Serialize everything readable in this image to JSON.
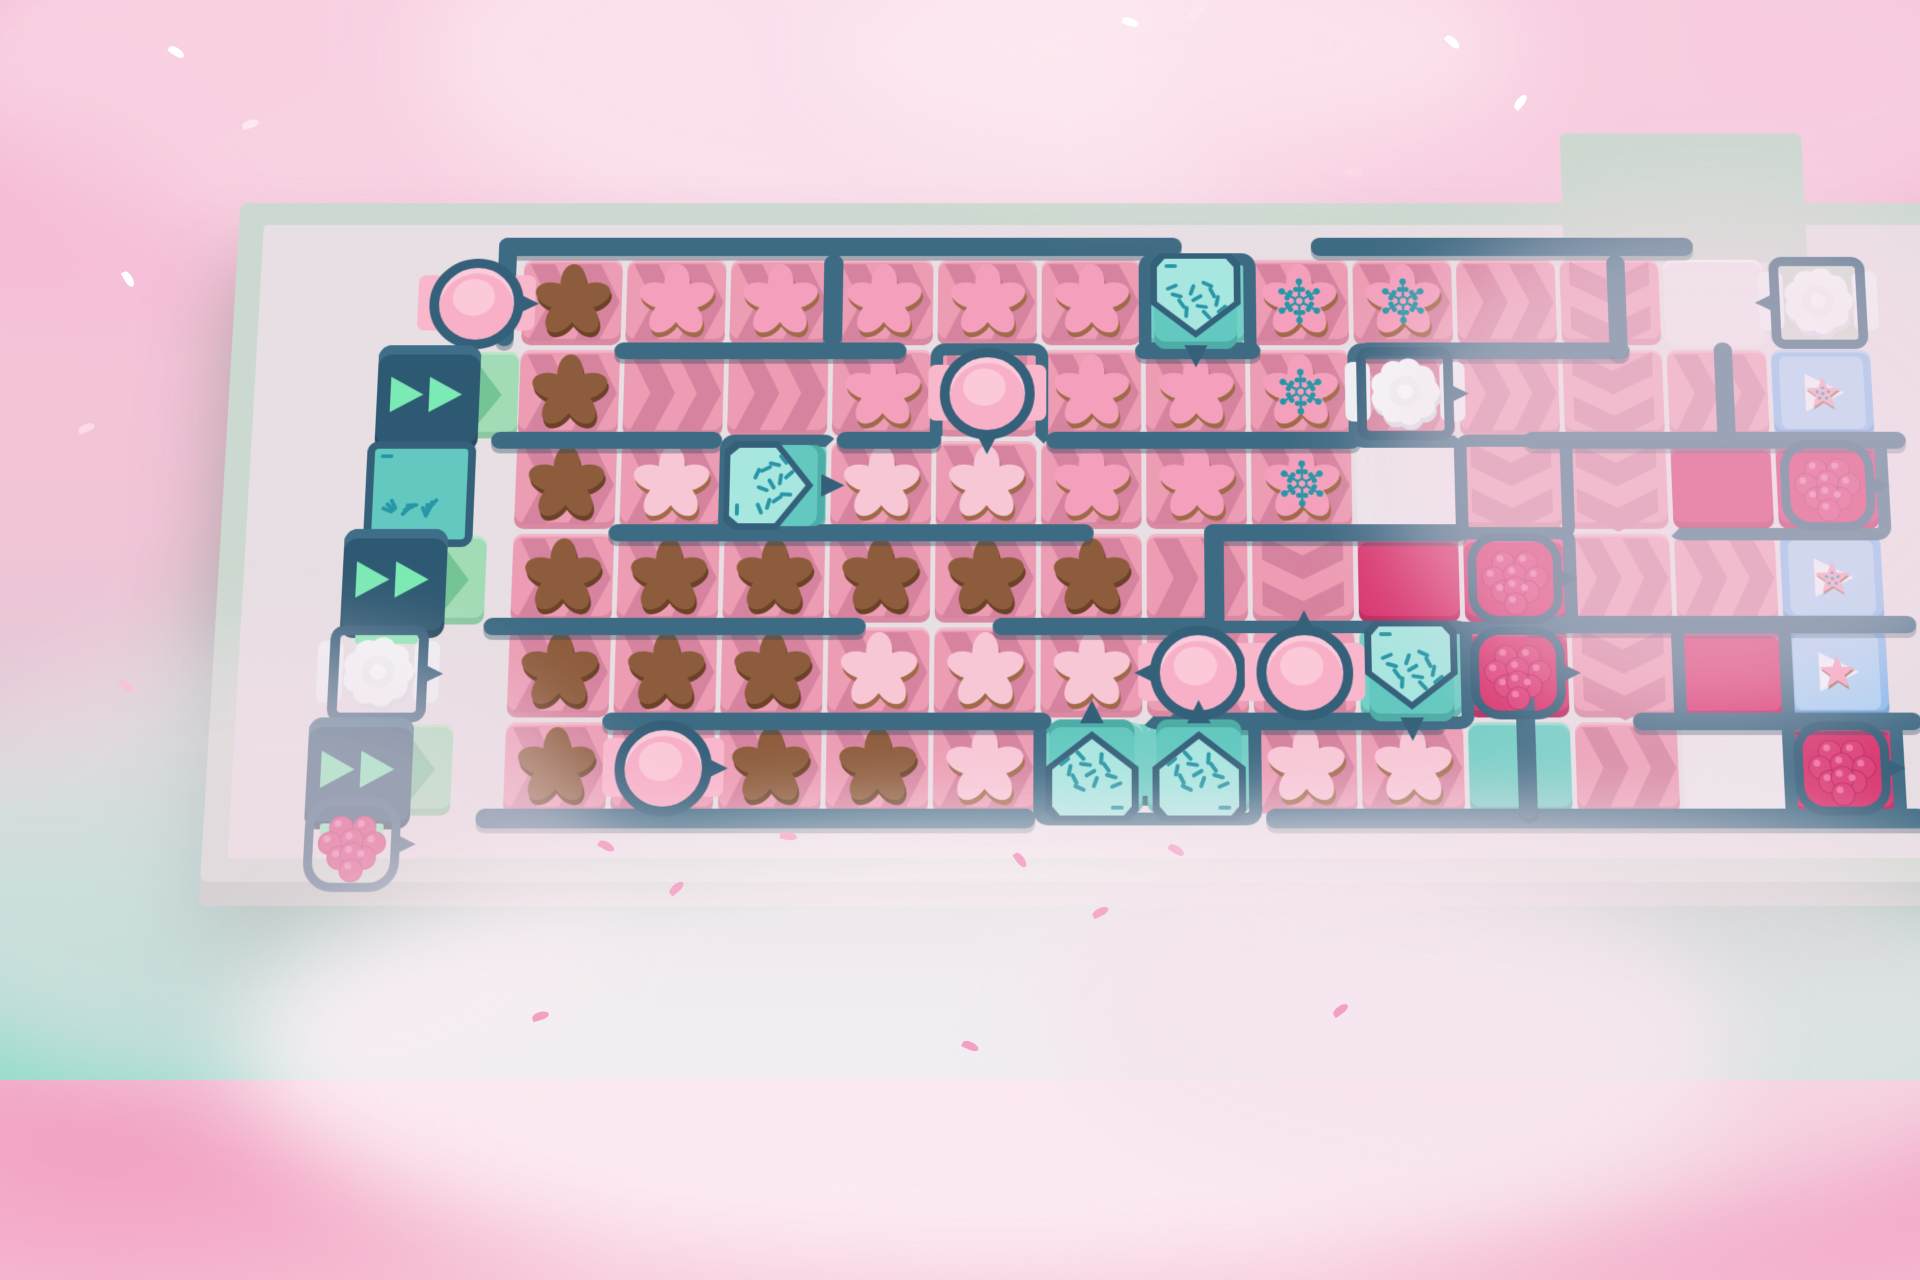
{
  "game": {
    "scene": "cookie-conveyor-puzzle-level",
    "view": "top-down-board-in-clouds",
    "visible_text": "none"
  },
  "palette": {
    "sky_pink": "#f6b6d0",
    "sky_mint": "#8adec8",
    "frame": "#ccd9d0",
    "frame_side": "#b4c4bb",
    "floor": "#e7dfe4",
    "wall": "#3e6b84",
    "wall_dark": "#35607a",
    "conveyor_pink": "#ec9db4",
    "chevron_pink": "#d5829e",
    "start_mint": "#a2dcb6",
    "chevron_mint": "#74c497",
    "teal_floor": "#74cfc6",
    "magenta_floor": "#d8366f",
    "goal_blue": "#86baee",
    "goal_blue_light": "#a9d2f4",
    "cookie_brown": "#8d5c3c",
    "cookie_brown_edge": "#6b4227",
    "cookie_pink": "#f4a0bd",
    "cookie_light_pink": "#f8c7d6",
    "cookie_edge": "#a06a4a",
    "sprinkle_teal": "#2796a6",
    "cream_white": "#f4f6f8",
    "berry": "#dd3f79",
    "dispenser_box": "#2e5972",
    "dispenser_arrows": "#7ceab4"
  },
  "board": {
    "cols": 13,
    "rows": 6,
    "cell_format": "type:direction:item:machine",
    "legend": {
      "types": {
        "p": "conveyor-tile",
        "m": "start-conveyor-tile",
        "t": "teal-floor-tile",
        "g": "magenta-floor-tile",
        "w": "floor-gap",
        "b": "goal-tile",
        "f": "walkway"
      },
      "directions": {
        "r": "right",
        "d": "down",
        "l": "left",
        "u": "up"
      },
      "items": {
        "bc": "chocolate-flower-cookie",
        "pc": "pink-flower-cookie",
        "lc": "light-pink-flower-cookie",
        "sc": "sprinkled-flower-cookie",
        "st": "star-cookie",
        "ss": "sprinkled-star-cookie"
      },
      "machines": {
        "sm": "sprinkle-dispenser",
        "fm": "frosting-dispenser",
        "cm": "cream-dispenser",
        "rm": "raspberry-dispenser",
        "dx": "speed-dispenser-box",
        "spb": "sprinkle-box"
      }
    },
    "grid": [
      [
        "p:r:bc:",
        "p:r:pc:",
        "p:r:pc:",
        "p:r:pc:",
        "p:r:pc:",
        "p:r:pc:",
        "t:::sm_d",
        "p:r:sc:",
        "p:r:sc:",
        "p:r::",
        "p:d::",
        "w:::",
        "f:::cm_l"
      ],
      [
        "p:r:bc:",
        "p:r::",
        "p:r::",
        "p:r:pc:",
        "p:d::fm_d",
        "p:r:pc:",
        "p:r:pc:",
        "p:r:sc:",
        "p:r::cm_r",
        "p:r::",
        "p:d::",
        "p:r::",
        "b::ss:"
      ],
      [
        "p:r:bc:",
        "p:r:lc:",
        "t:::sm_r",
        "p:r:lc:",
        "p:r:lc:",
        "p:r:pc:",
        "p:r:pc:",
        "p:r:sc:",
        "w:::",
        "p:d::",
        "p:d::",
        "g:::",
        "g:::rm"
      ],
      [
        "p:r:bc:",
        "p:r:bc:",
        "p:r:bc:",
        "p:r:bc:",
        "p:r:bc:",
        "p:r:bc:",
        "p:r::",
        "p:d::",
        "g:::",
        "g:::rm",
        "p:r::",
        "p:r::",
        "b::ss:"
      ],
      [
        "p:r:bc:",
        "p:r:bc:",
        "p:r:bc:",
        "p:r:lc:",
        "p:r:lc:",
        "p:r:lc:",
        "p:l::fm_l",
        "p:u::fm_u",
        "t:::sm_d",
        "g:::rm",
        "p:d::",
        "g:::",
        "b::st:"
      ],
      [
        "p:r:bc:",
        "p:r::fm_r",
        "p:r:bc:",
        "p:r:bc:",
        "p:r:lc:",
        "t:::sm_u",
        "t:::sm_u",
        "p:r:lc:",
        "p:r:lc:",
        "t:::",
        "p:r::",
        "w:::",
        "g:::rm"
      ]
    ],
    "left_strip": [
      {
        "code": "fm",
        "dir": "r",
        "x": 252,
        "y": 110,
        "mint": false,
        "name": "frosting-dispenser"
      },
      {
        "code": "dx",
        "dir": "r",
        "x": 206,
        "y": 208,
        "mint": true,
        "name": "speed-dispenser-box"
      },
      {
        "code": "spb",
        "dir": "r",
        "x": 194,
        "y": 306,
        "mint": false,
        "name": "sprinkle-box"
      },
      {
        "code": "dx",
        "dir": "r",
        "x": 180,
        "y": 404,
        "mint": true,
        "name": "speed-dispenser-box"
      },
      {
        "code": "cm",
        "dir": "r",
        "x": 168,
        "y": 502,
        "mint": false,
        "name": "cream-dispenser"
      },
      {
        "code": "dx",
        "dir": "r",
        "x": 154,
        "y": 600,
        "mint": true,
        "name": "speed-dispenser-box"
      },
      {
        "code": "rm",
        "dir": "r",
        "x": 150,
        "y": 676,
        "mint": false,
        "name": "raspberry-dispenser"
      }
    ],
    "walls": [
      {
        "x": -0.25,
        "y": -0.24,
        "w": 6.6,
        "h": 0.2
      },
      {
        "x": 7.6,
        "y": -0.24,
        "w": 3.7,
        "h": 0.2
      },
      {
        "x": -0.25,
        "y": -0.24,
        "w": 0.18,
        "h": 1.2
      },
      {
        "x": 2.9,
        "y": -0.05,
        "w": 0.18,
        "h": 1.0
      },
      {
        "x": 0.9,
        "y": 0.92,
        "w": 2.8,
        "h": 0.18
      },
      {
        "x": 5.9,
        "y": 0.92,
        "w": 1.2,
        "h": 0.18
      },
      {
        "x": 8.05,
        "y": 0.92,
        "w": 2.6,
        "h": 0.18
      },
      {
        "x": 10.45,
        "y": -0.05,
        "w": 0.18,
        "h": 1.15
      },
      {
        "x": -0.25,
        "y": 1.9,
        "w": 2.2,
        "h": 0.18
      },
      {
        "x": 3.05,
        "y": 1.9,
        "w": 1.0,
        "h": 0.18
      },
      {
        "x": 5.05,
        "y": 1.9,
        "w": 3.0,
        "h": 0.18
      },
      {
        "x": 9.6,
        "y": 1.9,
        "w": 3.65,
        "h": 0.18
      },
      {
        "x": 11.45,
        "y": 0.92,
        "w": 0.18,
        "h": 1.1
      },
      {
        "x": 0.9,
        "y": 2.9,
        "w": 4.6,
        "h": 0.18
      },
      {
        "x": 6.55,
        "y": 2.9,
        "w": 2.5,
        "h": 0.18
      },
      {
        "x": 6.55,
        "y": 2.9,
        "w": 0.18,
        "h": 2.2
      },
      {
        "x": -0.25,
        "y": 3.9,
        "w": 3.6,
        "h": 0.18
      },
      {
        "x": 4.55,
        "y": 3.9,
        "w": 2.2,
        "h": 0.18
      },
      {
        "x": 9.55,
        "y": 3.88,
        "w": 3.7,
        "h": 0.18
      },
      {
        "x": 0.9,
        "y": 4.9,
        "w": 4.2,
        "h": 0.18
      },
      {
        "x": 6.2,
        "y": 4.9,
        "w": 2.6,
        "h": 0.18
      },
      {
        "x": 10.55,
        "y": 4.9,
        "w": 2.7,
        "h": 0.18
      },
      {
        "x": -0.25,
        "y": 5.9,
        "w": 5.2,
        "h": 0.2
      },
      {
        "x": 7.1,
        "y": 5.9,
        "w": 6.15,
        "h": 0.2
      },
      {
        "x": 9.45,
        "y": 4.4,
        "w": 0.18,
        "h": 1.6
      }
    ],
    "pens": [
      {
        "c": 7,
        "r": 1,
        "w": 1,
        "h": 1,
        "open": "bottom"
      },
      {
        "c": 5,
        "r": 2,
        "w": 1,
        "h": 1,
        "open": "bottom"
      },
      {
        "c": 3,
        "r": 3,
        "w": 1,
        "h": 1,
        "open": "right"
      },
      {
        "c": 9,
        "r": 2,
        "w": 1,
        "h": 1,
        "open": "right"
      },
      {
        "c": 7,
        "r": 5,
        "w": 3,
        "h": 1,
        "open": "left"
      },
      {
        "c": 9,
        "r": 4,
        "w": 2,
        "h": 1,
        "open": "left"
      },
      {
        "c": 12,
        "r": 3,
        "w": 2,
        "h": 1,
        "open": "left"
      },
      {
        "c": 12,
        "r": 5,
        "w": 1,
        "h": 1,
        "open": "top"
      },
      {
        "c": 13,
        "r": 6,
        "w": 1,
        "h": 1,
        "open": "top"
      },
      {
        "c": 6,
        "r": 6,
        "w": 2,
        "h": 1,
        "open": "top"
      },
      {
        "c": 10,
        "r": 3,
        "w": 1,
        "h": 1,
        "open": "bottom"
      }
    ],
    "extras": {
      "dock": {
        "c": 5.9,
        "r": 6.02,
        "w": 2.25,
        "h": 0.75,
        "color": "#74cfc6"
      },
      "walkway": {
        "c": 11.05,
        "r": -0.42,
        "w": 2.35,
        "h": 1.45,
        "color": "#ccd9d0"
      }
    }
  },
  "decor": {
    "clouds": [
      {
        "layer": "back",
        "x": -80,
        "y": -140,
        "w": 900,
        "h": 420,
        "c": "#f9d3e4",
        "o": 0.95
      },
      {
        "layer": "back",
        "x": 420,
        "y": -160,
        "w": 1200,
        "h": 430,
        "c": "#fbe2ee",
        "o": 0.95
      },
      {
        "layer": "back",
        "x": 1150,
        "y": -120,
        "w": 900,
        "h": 400,
        "c": "#f8cfe2",
        "o": 0.95
      },
      {
        "layer": "back",
        "x": -260,
        "y": 120,
        "w": 520,
        "h": 640,
        "c": "#f5bcd6",
        "o": 0.6
      },
      {
        "layer": "front",
        "x": 820,
        "y": -70,
        "w": 700,
        "h": 230,
        "c": "#fdeaf2",
        "o": 0.7
      },
      {
        "layer": "front",
        "x": 1380,
        "y": 190,
        "w": 660,
        "h": 540,
        "c": "#f7dce9",
        "o": 0.5
      },
      {
        "layer": "front",
        "x": -140,
        "y": 640,
        "w": 760,
        "h": 460,
        "c": "#f2dde8",
        "o": 0.55
      },
      {
        "layer": "front",
        "x": 240,
        "y": 820,
        "w": 1500,
        "h": 460,
        "c": "#fceff5",
        "o": 0.9
      },
      {
        "layer": "front",
        "x": 1050,
        "y": 800,
        "w": 1000,
        "h": 420,
        "c": "#f6e4ed",
        "o": 0.75
      }
    ],
    "petals": [
      {
        "x": 168,
        "y": 48,
        "a": 35,
        "c": "#ffffff"
      },
      {
        "x": 242,
        "y": 120,
        "a": -15,
        "c": "#fde7f0"
      },
      {
        "x": 120,
        "y": 275,
        "a": 60,
        "c": "#ffffff"
      },
      {
        "x": 1122,
        "y": 18,
        "a": 20,
        "c": "#ffffff"
      },
      {
        "x": 1188,
        "y": 8,
        "a": -30,
        "c": "#fde7f0"
      },
      {
        "x": 1444,
        "y": 38,
        "a": 45,
        "c": "#ffffff"
      },
      {
        "x": 1512,
        "y": 98,
        "a": -50,
        "c": "#ffffff"
      },
      {
        "x": 1345,
        "y": 168,
        "a": 15,
        "c": "#fdd9e8"
      },
      {
        "x": 598,
        "y": 842,
        "a": 30,
        "c": "#f5aacb"
      },
      {
        "x": 668,
        "y": 884,
        "a": -40,
        "c": "#f5aacb"
      },
      {
        "x": 780,
        "y": 832,
        "a": 10,
        "c": "#f7bcd5"
      },
      {
        "x": 1012,
        "y": 856,
        "a": 55,
        "c": "#f5aacb"
      },
      {
        "x": 1092,
        "y": 908,
        "a": -25,
        "c": "#f5aacb"
      },
      {
        "x": 1168,
        "y": 846,
        "a": 35,
        "c": "#f7bcd5"
      },
      {
        "x": 532,
        "y": 1012,
        "a": -15,
        "c": "#f2a0c4"
      },
      {
        "x": 962,
        "y": 1042,
        "a": 25,
        "c": "#f2a0c4"
      },
      {
        "x": 1332,
        "y": 1006,
        "a": -35,
        "c": "#f2a0c4"
      },
      {
        "x": 118,
        "y": 682,
        "a": 40,
        "c": "#f7c3d9"
      },
      {
        "x": 78,
        "y": 424,
        "a": -20,
        "c": "#fbd9e8"
      }
    ]
  }
}
